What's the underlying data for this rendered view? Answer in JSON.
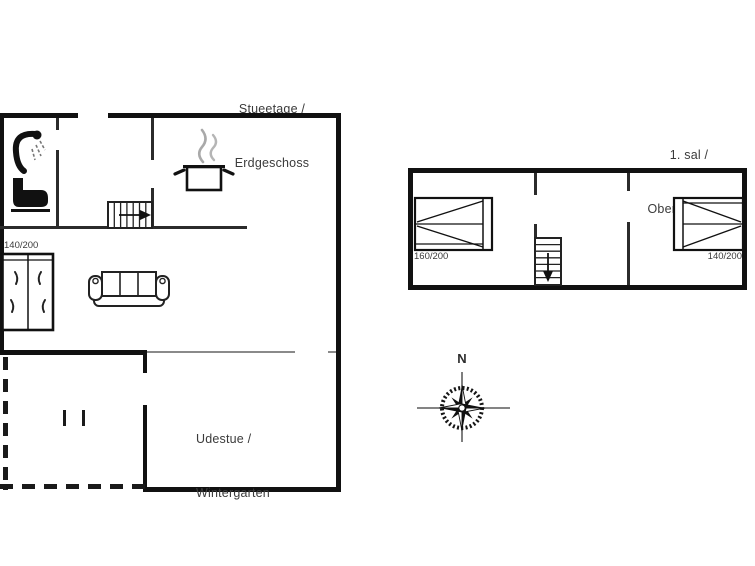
{
  "ground_floor": {
    "title_line1": "Stueetage /",
    "title_line2": "Erdgeschoss",
    "bed_label": "140/200",
    "conservatory_line1": "Udestue /",
    "conservatory_line2": "Wintergarten"
  },
  "upper_floor": {
    "title_line1": "1. sal /",
    "title_line2": "Obergeschoss",
    "bed_left_label": "160/200",
    "bed_right_label": "140/200"
  },
  "compass": {
    "north_label": "N"
  },
  "colors": {
    "wall": "#111111",
    "thin_wall": "#2b2b2b",
    "gray_line": "#8a8a8a",
    "text": "#3b3b3b",
    "background": "#ffffff"
  }
}
